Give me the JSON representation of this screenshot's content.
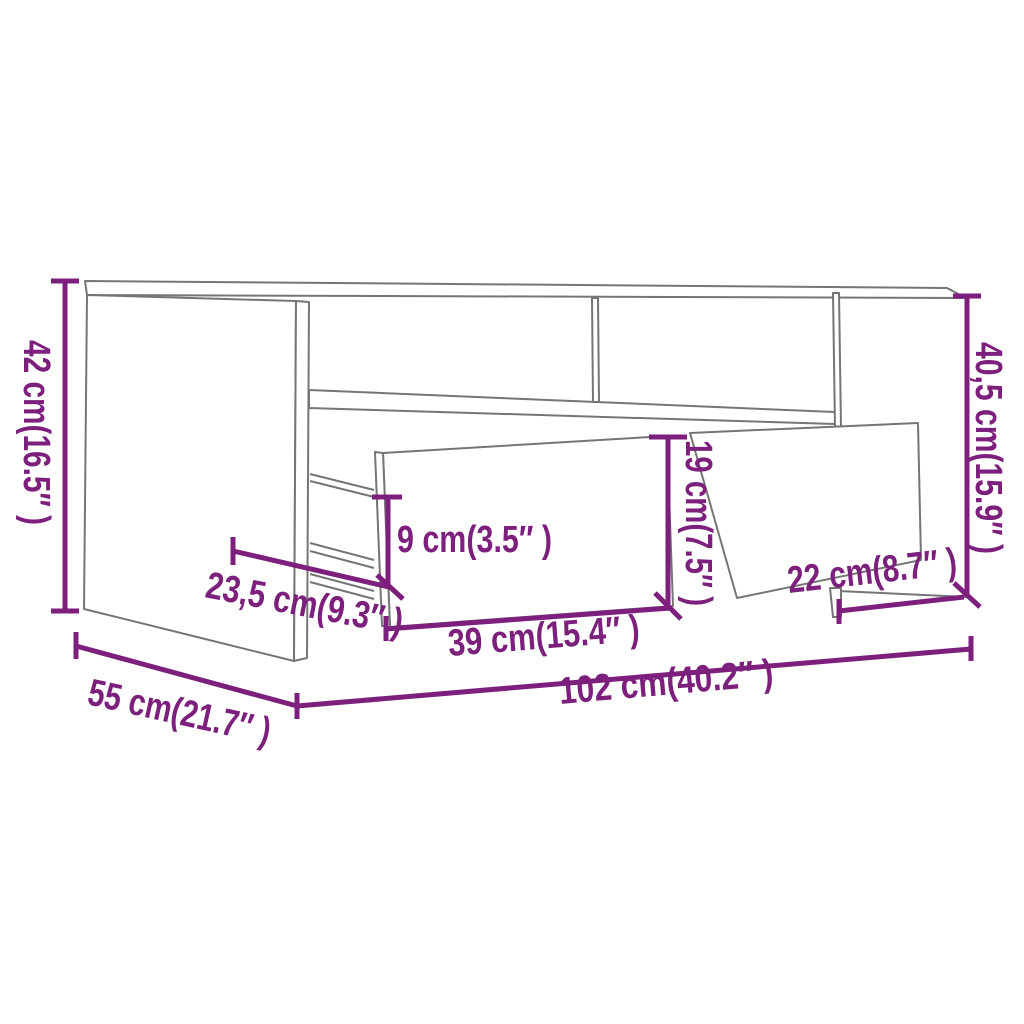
{
  "diagram": {
    "type": "furniture-dimension-diagram",
    "product": "coffee table with open shelf and two pulled-out drawers",
    "colors": {
      "dimension": "#7D1F7D",
      "outline": "#757575",
      "background": "#FFFFFF"
    },
    "dimensions": {
      "height_left": "42 cm(16.5″ )",
      "height_right": "40,5 cm(15.9″ )",
      "drawer_front_height": "19 cm(7.5″ )",
      "inner_drawer_height": "9 cm(3.5″ )",
      "drawer_depth": "23,5 cm(9.3″ )",
      "drawer_width": "39 cm(15.4″ )",
      "side_compartment_width": "22 cm(8.7″ )",
      "depth": "55 cm(21.7″ )",
      "width": "102 cm(40.2″ )"
    }
  }
}
